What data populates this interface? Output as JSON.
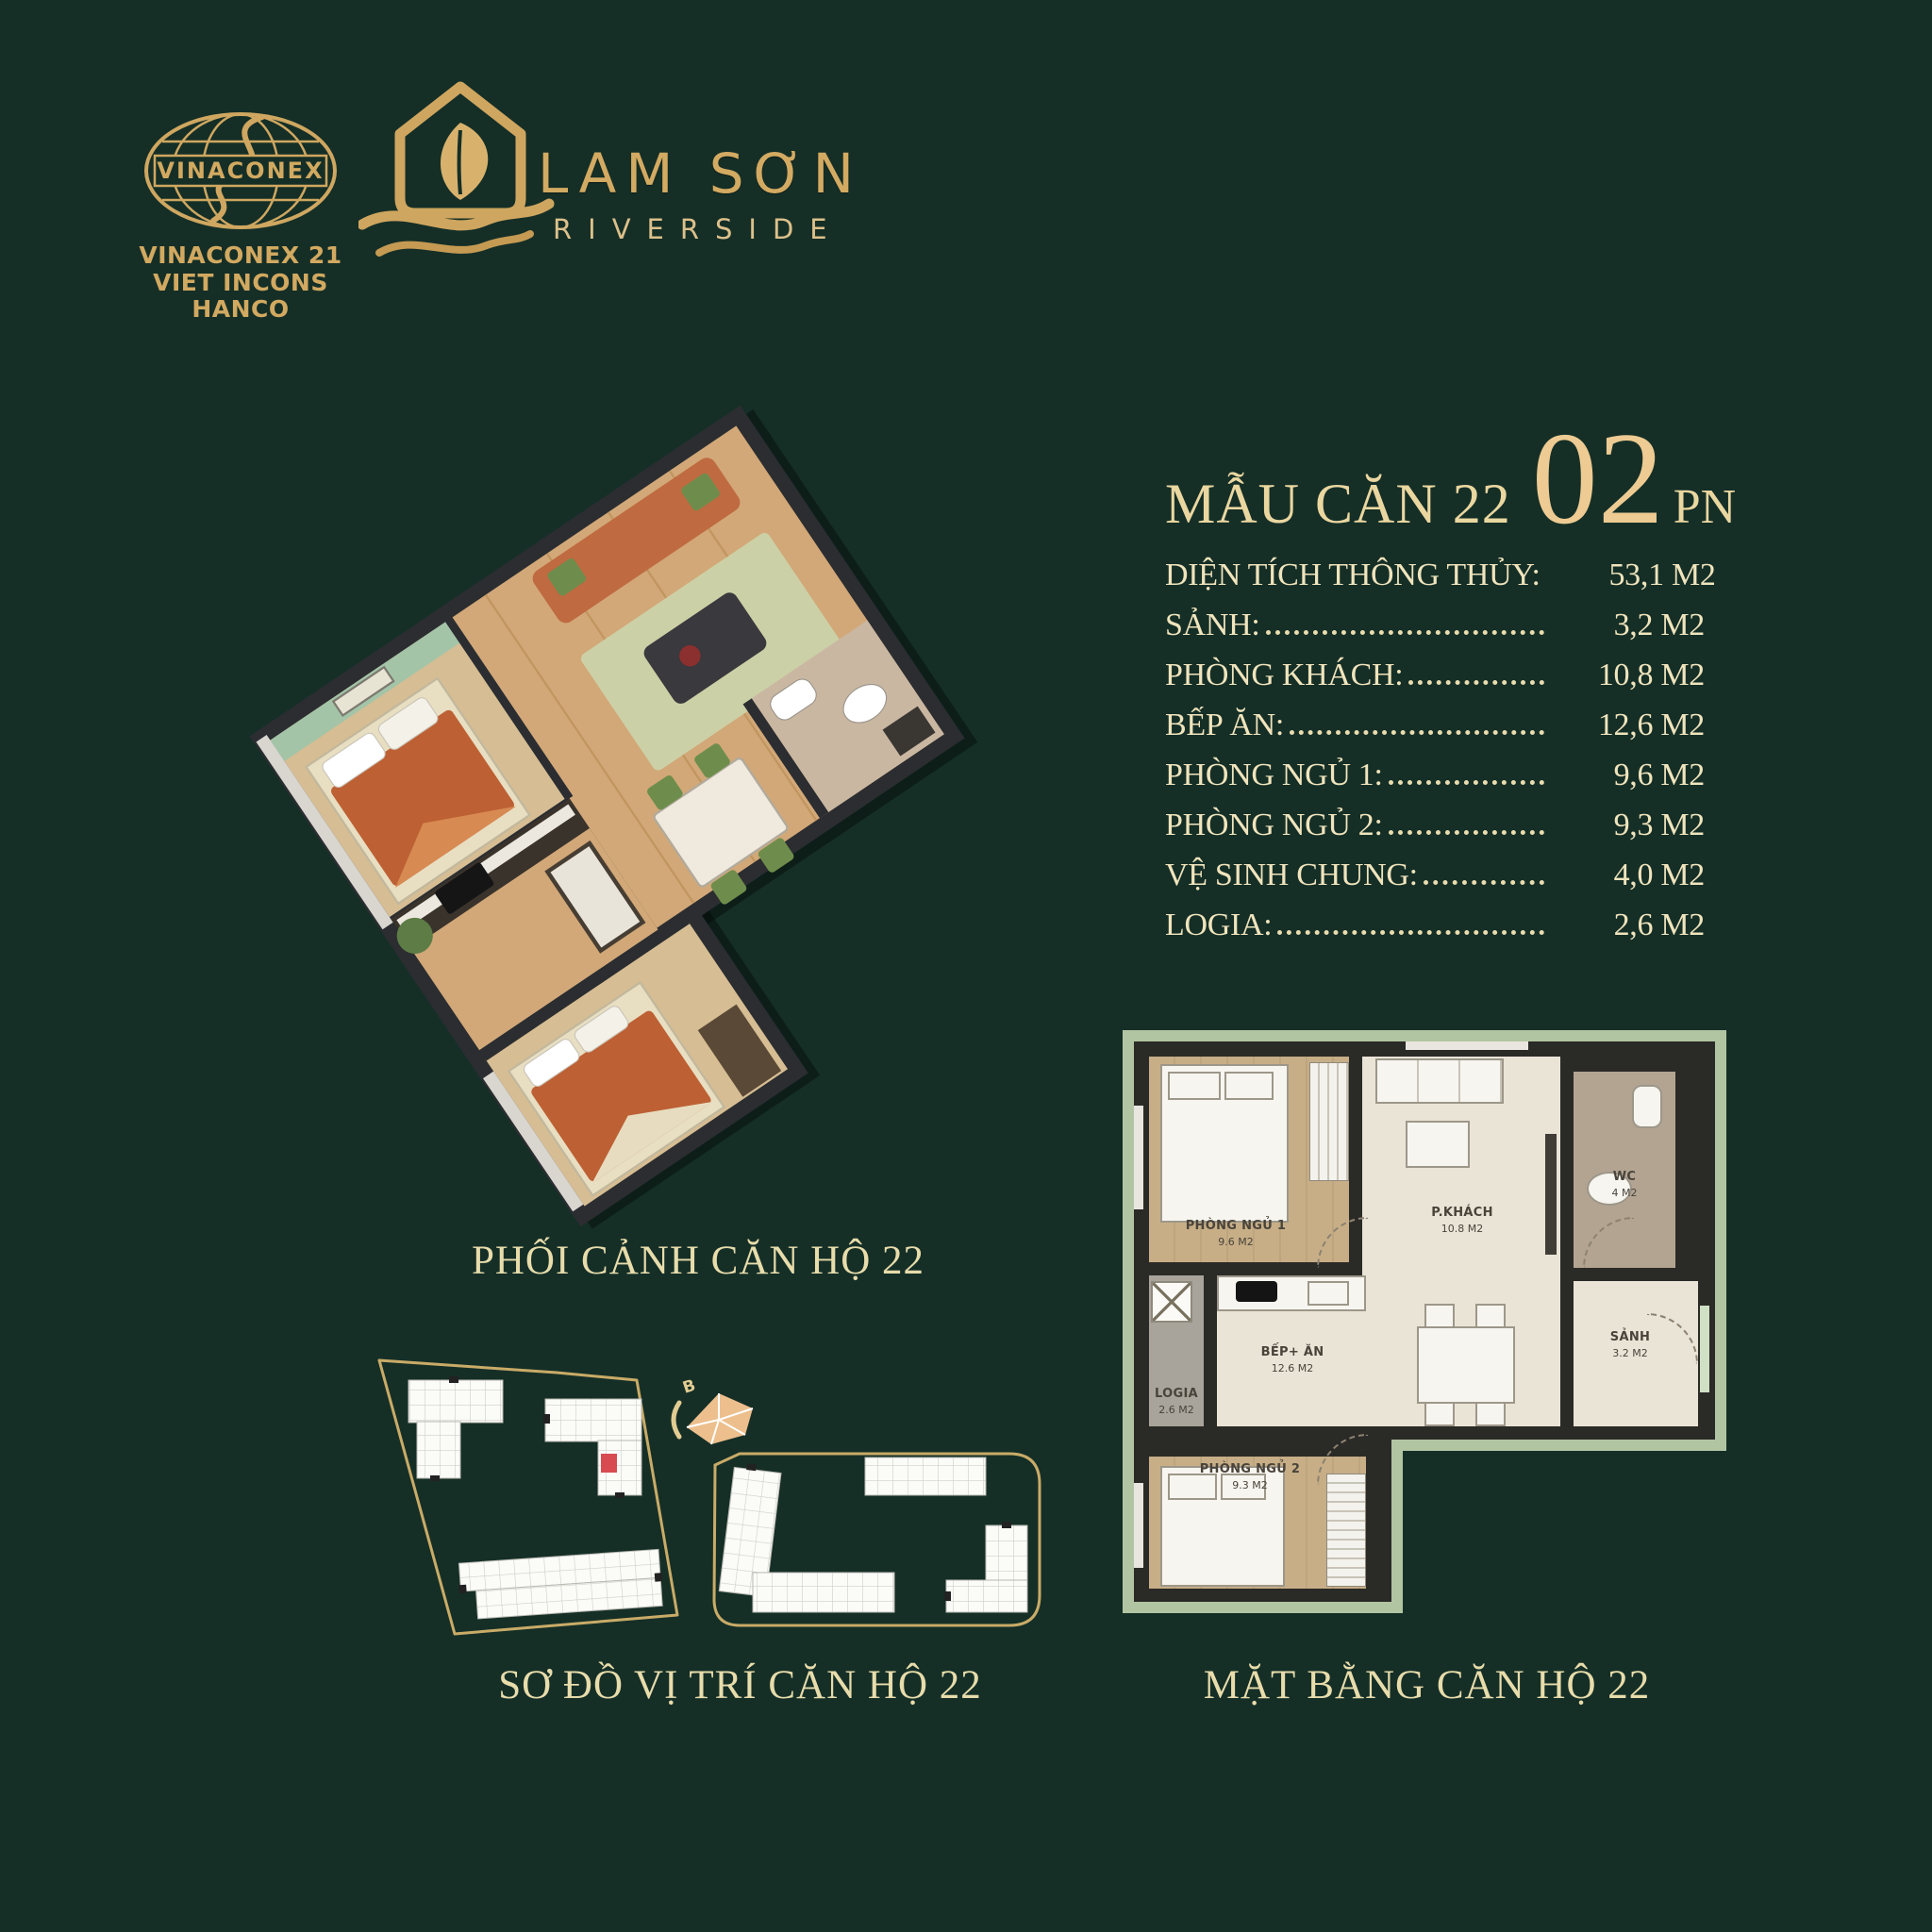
{
  "page": {
    "background": "#152f27",
    "gold": "#d2a960",
    "cream": "#f0e4bc"
  },
  "branding": {
    "vinaconex": {
      "logo_text": "VINACONEX",
      "company_lines": [
        "VINACONEX 21",
        "VIET INCONS",
        "HANCO"
      ]
    },
    "project": {
      "name": "LAM SƠN",
      "subtitle": "RIVERSIDE"
    }
  },
  "unit_panel": {
    "title": "MẪU CĂN 22",
    "bedroom_count": "02",
    "bedroom_unit": "PN",
    "specs": [
      {
        "label": "DIỆN TÍCH THÔNG THỦY:",
        "value": "53,1 M2",
        "dots": false
      },
      {
        "label": "SẢNH:",
        "value": "3,2 M2",
        "dots": true
      },
      {
        "label": "PHÒNG KHÁCH:",
        "value": "10,8 M2",
        "dots": true
      },
      {
        "label": "BẾP ĂN:",
        "value": "12,6 M2",
        "dots": true
      },
      {
        "label": "PHÒNG NGỦ 1:",
        "value": "9,6 M2",
        "dots": true
      },
      {
        "label": "PHÒNG NGỦ 2:",
        "value": "9,3 M2",
        "dots": true
      },
      {
        "label": "VỆ SINH CHUNG:",
        "value": "4,0 M2",
        "dots": true
      },
      {
        "label": "LOGIA:",
        "value": "2,6 M2",
        "dots": true
      }
    ]
  },
  "captions": {
    "perspective": "PHỐI CẢNH CĂN HỘ 22",
    "site_map": "SƠ ĐỒ VỊ TRÍ CĂN HỘ 22",
    "floor_plan": "MẶT BẰNG CĂN HỘ 22"
  },
  "floor_plan_labels": {
    "bedroom1": {
      "name": "PHÒNG NGỦ 1",
      "area": "9.6 M2"
    },
    "living": {
      "name": "P.KHÁCH",
      "area": "10.8 M2"
    },
    "wc": {
      "name": "WC",
      "area": "4 M2"
    },
    "hall": {
      "name": "SẢNH",
      "area": "3.2 M2"
    },
    "kitchen": {
      "name": "BẾP+ ĂN",
      "area": "12.6 M2"
    },
    "logia": {
      "name": "LOGIA",
      "area": "2.6 M2"
    },
    "bedroom2": {
      "name": "PHÒNG NGỦ 2",
      "area": "9.3 M2"
    }
  },
  "site_map": {
    "compass_label": "B"
  }
}
